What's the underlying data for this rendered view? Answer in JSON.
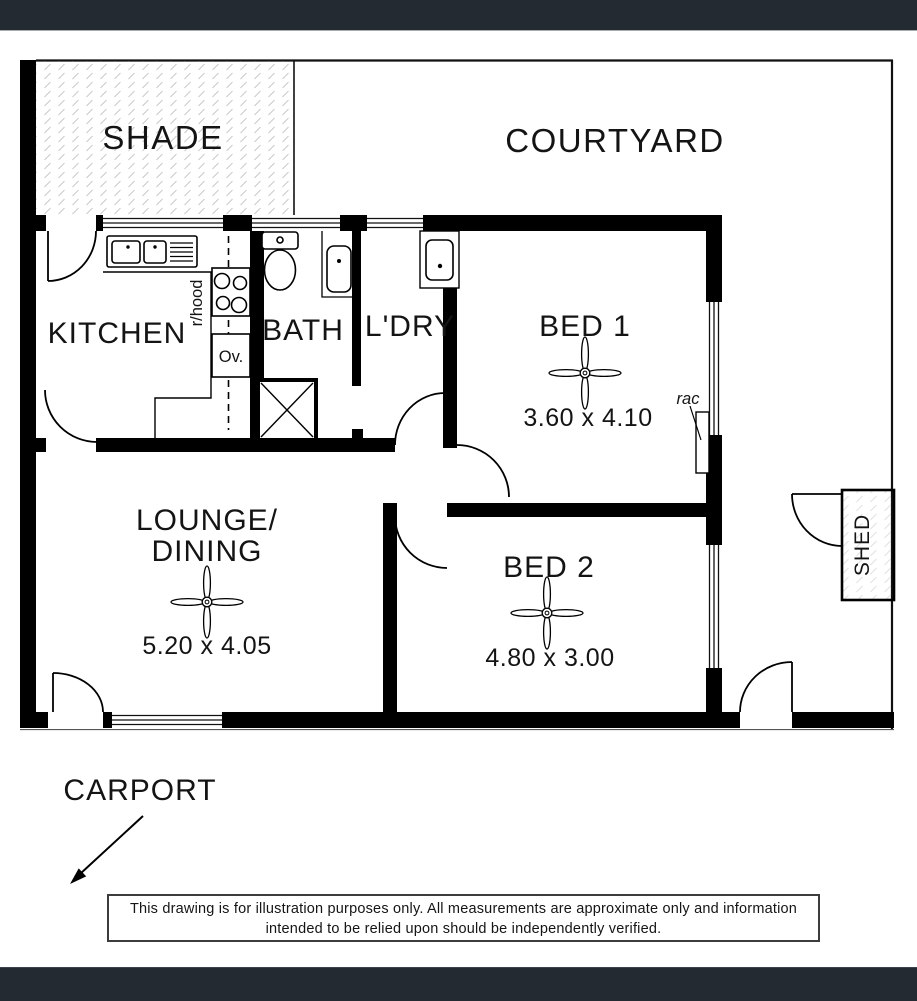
{
  "colors": {
    "frame_bar": "#232a32",
    "wall": "#000000",
    "hatch_tick": "#c9cacc",
    "shed_hatch_tick": "#e2e2e2"
  },
  "floor_plan": {
    "areas": {
      "shade": "SHADE",
      "courtyard": "COURTYARD",
      "carport": "CARPORT",
      "shed": "SHED"
    },
    "rooms": {
      "kitchen": {
        "label": "KITCHEN"
      },
      "bath": {
        "label": "BATH"
      },
      "laundry": {
        "label": "L'DRY"
      },
      "bed1": {
        "label": "BED 1",
        "dimensions": "3.60 x 4.10"
      },
      "bed2": {
        "label": "BED 2",
        "dimensions": "4.80 x 3.00"
      },
      "lounge": {
        "label_line1": "LOUNGE/",
        "label_line2": "DINING",
        "dimensions": "5.20 x 4.05"
      }
    },
    "annotations": {
      "rangehood": "r/hood",
      "oven": "Ov.",
      "air_conditioner": "rac"
    },
    "fixtures": [
      "kitchen-sink-icon",
      "cooktop-icon",
      "oven-icon",
      "toilet-icon",
      "basin-icon",
      "shower-icon",
      "laundry-trough-icon",
      "ceiling-fan-icon",
      "air-conditioner-icon",
      "door-arc-icon",
      "window-icon",
      "arrow-icon"
    ]
  },
  "disclaimer": {
    "line1": "This drawing is for illustration purposes only. All measurements are approximate only and information",
    "line2": "intended to be relied upon should be independently verified."
  }
}
